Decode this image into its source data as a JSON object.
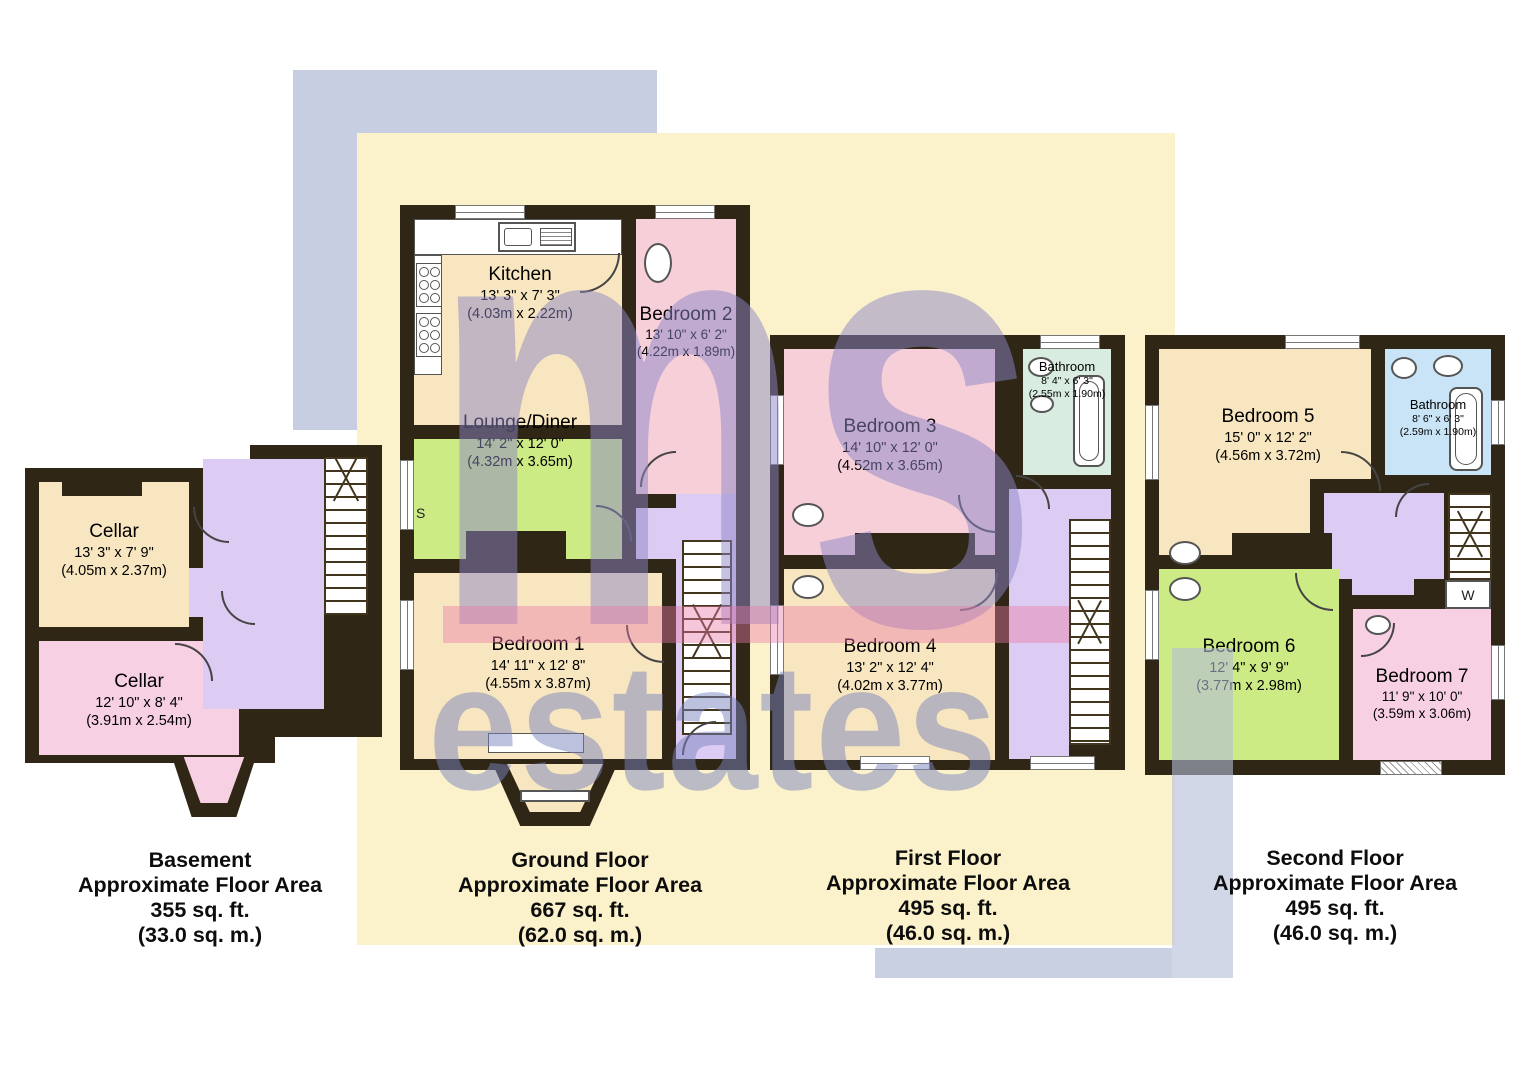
{
  "watermark": {
    "logo_top": "ms",
    "logo_bottom": "estates"
  },
  "annotations": {
    "storage": "S",
    "wardrobe": "W"
  },
  "palette": {
    "wall": "#2f2616",
    "room_cream": "#f7e6bf",
    "room_pink": "#f7cfd9",
    "room_pink_alt": "#f8d0e4",
    "room_green": "#cdeb84",
    "hall_lavender": "#dccbf2",
    "bathroom_teal": "#d8ece0",
    "bathroom_blue": "#c9e4f6",
    "bg_yellow": "#fbf2cb",
    "bg_gray": "#c7cee1",
    "watermark_purple": "#8c86c6",
    "watermark_blue": "#7a84bd",
    "stripe_pink": "#ea79a9"
  },
  "floors": {
    "basement": {
      "label": {
        "title": "Basement",
        "area_label": "Approximate Floor Area",
        "sqft": "355 sq. ft.",
        "sqm": "(33.0 sq. m.)"
      },
      "rooms": {
        "cellar_rear": {
          "name": "Cellar",
          "dims_ft": "13' 3\" x 7' 9\"",
          "dims_m": "(4.05m x 2.37m)"
        },
        "cellar_front": {
          "name": "Cellar",
          "dims_ft": "12' 10\" x 8' 4\"",
          "dims_m": "(3.91m x 2.54m)"
        }
      }
    },
    "ground": {
      "label": {
        "title": "Ground Floor",
        "area_label": "Approximate Floor Area",
        "sqft": "667 sq. ft.",
        "sqm": "(62.0 sq. m.)"
      },
      "rooms": {
        "kitchen": {
          "name": "Kitchen",
          "dims_ft": "13' 3\" x 7' 3\"",
          "dims_m": "(4.03m x 2.22m)"
        },
        "bedroom2": {
          "name": "Bedroom 2",
          "dims_ft": "13' 10\" x 6' 2\"",
          "dims_m": "(4.22m x 1.89m)"
        },
        "lounge": {
          "name": "Lounge/Diner",
          "dims_ft": "14' 2\" x 12' 0\"",
          "dims_m": "(4.32m x 3.65m)"
        },
        "bedroom1": {
          "name": "Bedroom 1",
          "dims_ft": "14' 11\" x 12' 8\"",
          "dims_m": "(4.55m x 3.87m)"
        }
      }
    },
    "first": {
      "label": {
        "title": "First Floor",
        "area_label": "Approximate Floor Area",
        "sqft": "495 sq. ft.",
        "sqm": "(46.0 sq. m.)"
      },
      "rooms": {
        "bedroom3": {
          "name": "Bedroom 3",
          "dims_ft": "14' 10\" x 12' 0\"",
          "dims_m": "(4.52m x 3.65m)"
        },
        "bathroom": {
          "name": "Bathroom",
          "dims_ft": "8' 4\" x 6' 3\"",
          "dims_m": "(2.55m x 1.90m)"
        },
        "bedroom4": {
          "name": "Bedroom 4",
          "dims_ft": "13' 2\" x 12' 4\"",
          "dims_m": "(4.02m x 3.77m)"
        }
      }
    },
    "second": {
      "label": {
        "title": "Second Floor",
        "area_label": "Approximate Floor Area",
        "sqft": "495 sq. ft.",
        "sqm": "(46.0 sq. m.)"
      },
      "rooms": {
        "bedroom5": {
          "name": "Bedroom 5",
          "dims_ft": "15' 0\" x 12' 2\"",
          "dims_m": "(4.56m x 3.72m)"
        },
        "bathroom": {
          "name": "Bathroom",
          "dims_ft": "8' 6\" x 6' 3\"",
          "dims_m": "(2.59m x 1.90m)"
        },
        "bedroom6": {
          "name": "Bedroom 6",
          "dims_ft": "12' 4\" x 9' 9\"",
          "dims_m": "(3.77m x 2.98m)"
        },
        "bedroom7": {
          "name": "Bedroom 7",
          "dims_ft": "11' 9\" x 10' 0\"",
          "dims_m": "(3.59m x 3.06m)"
        }
      }
    }
  }
}
